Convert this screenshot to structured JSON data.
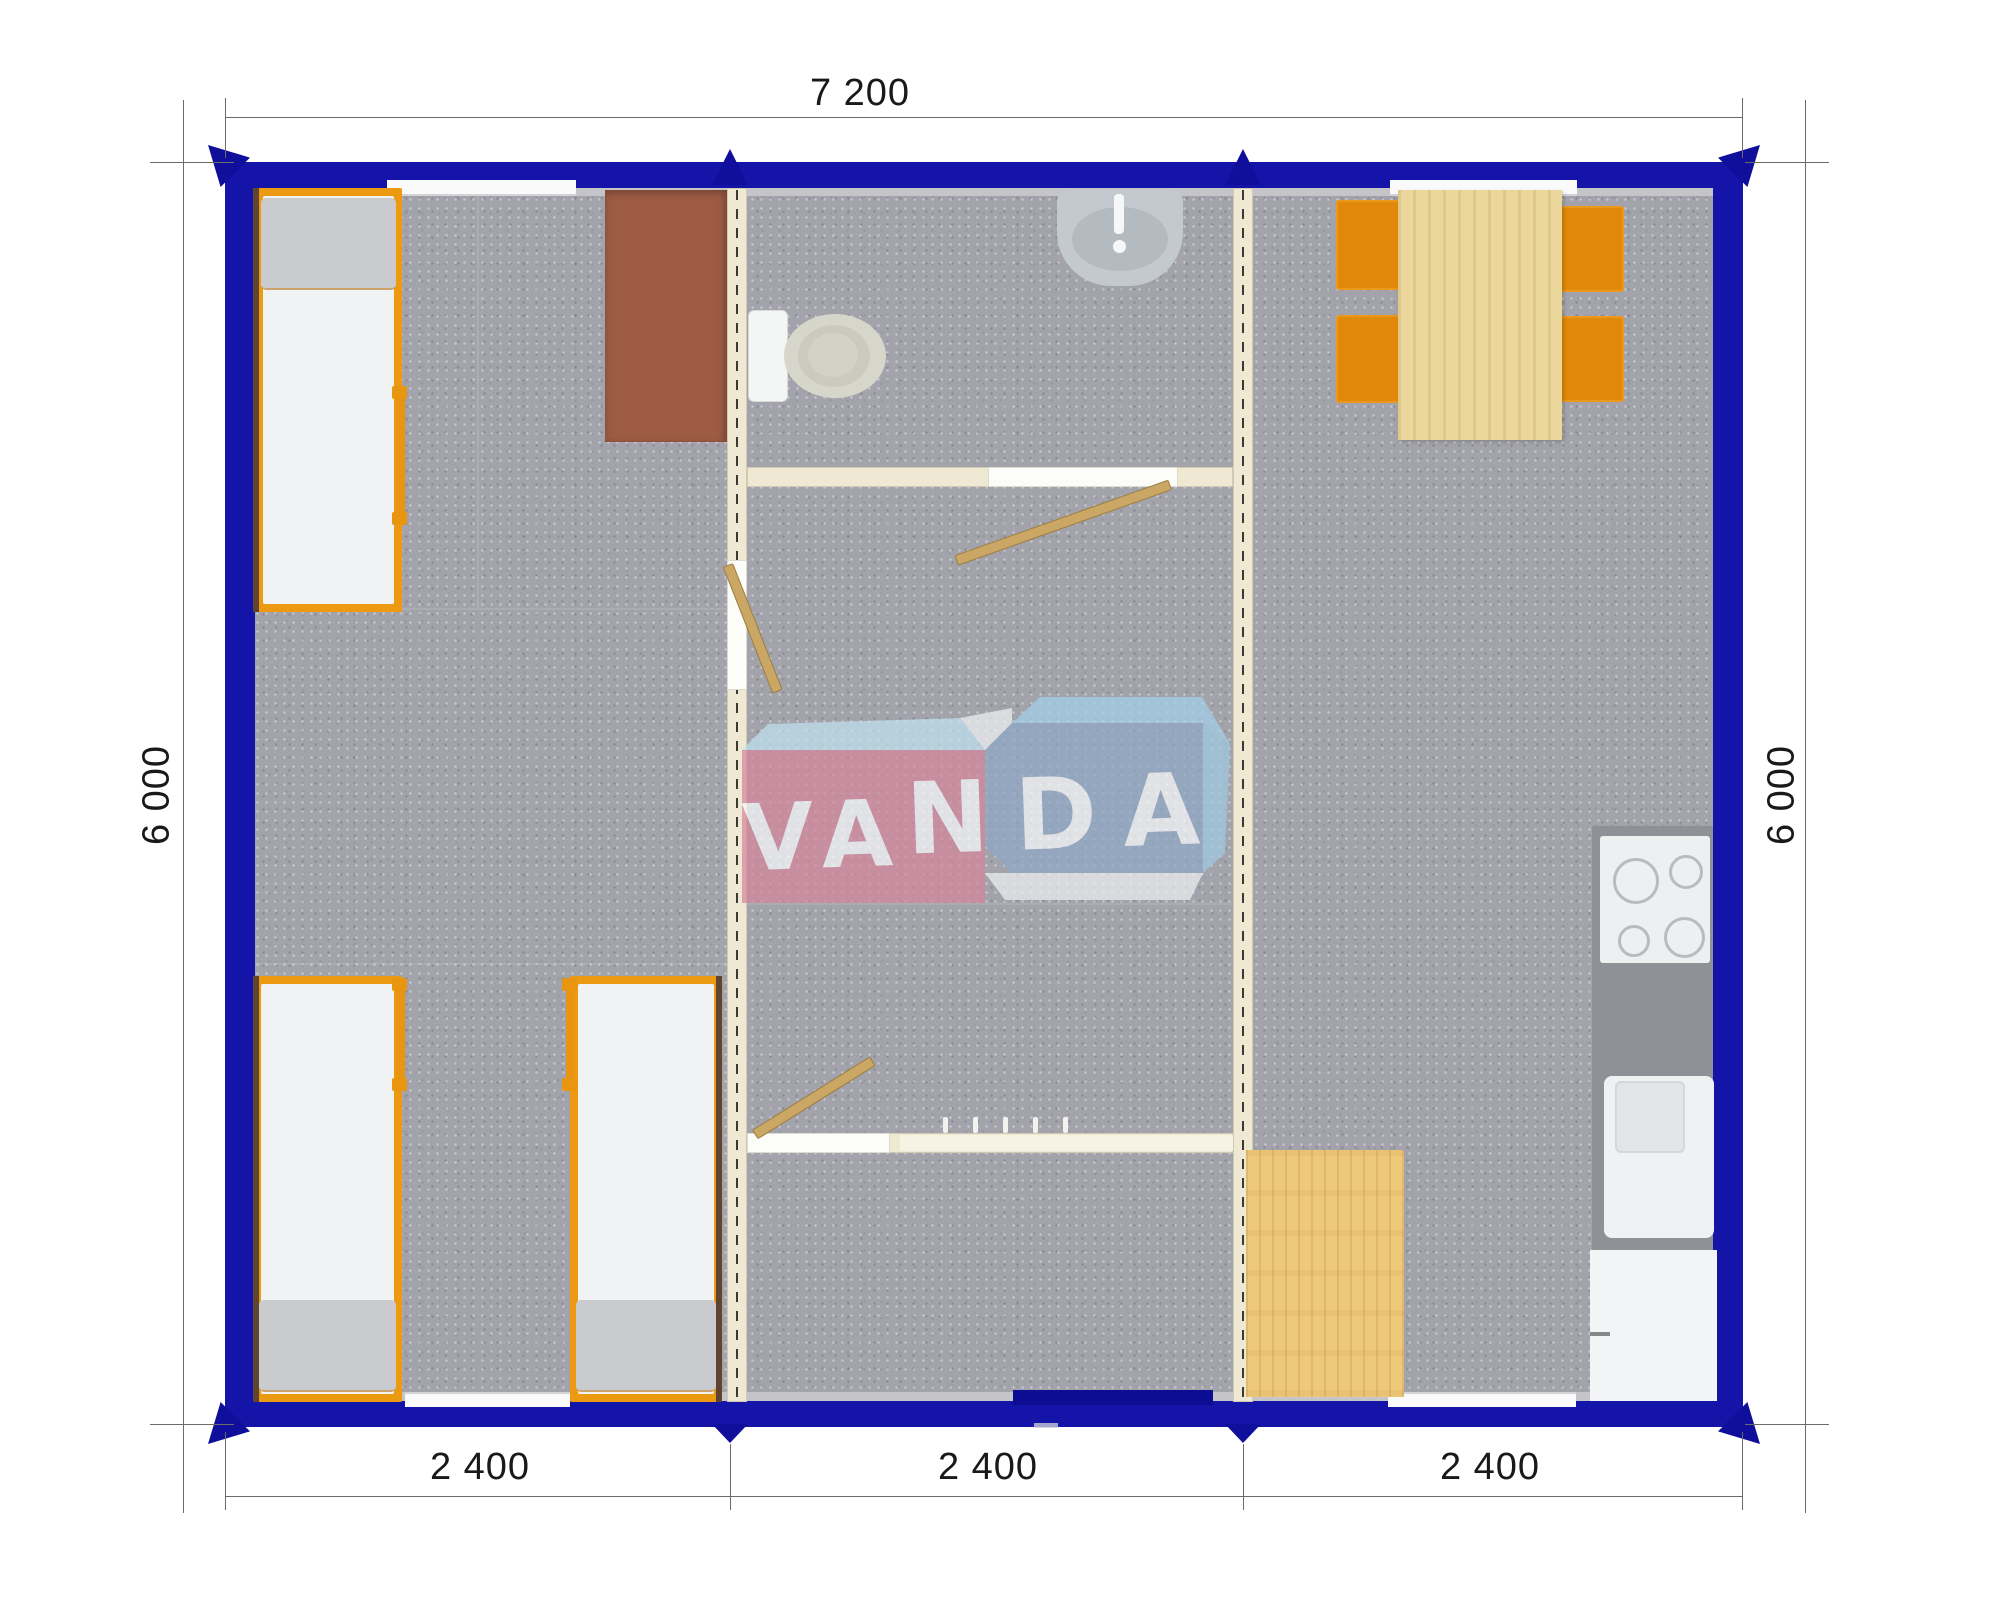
{
  "plan": {
    "type": "modular-building-floor-plan",
    "modules": [
      {
        "name": "bedroom-module",
        "furniture": [
          "bed",
          "bed",
          "bed",
          "wardrobe-desk"
        ]
      },
      {
        "name": "sanitary-entry-module",
        "furniture": [
          "toilet",
          "wash-basin",
          "door",
          "door",
          "door",
          "coat-hooks",
          "entrance-door"
        ]
      },
      {
        "name": "kitchen-dining-module",
        "furniture": [
          "dining-table",
          "chair",
          "chair",
          "chair",
          "chair",
          "cooktop",
          "kitchen-sink",
          "kitchen-cabinet",
          "side-table"
        ]
      }
    ]
  },
  "dimensions": {
    "top": "7 200",
    "left": "6 000",
    "right": "6 000",
    "bottom": [
      "2 400",
      "2 400",
      "2 400"
    ]
  },
  "watermark": {
    "full": "VANDA",
    "part1": "VA",
    "part2": "NDA"
  },
  "colors": {
    "wall_blue": "#1414A8",
    "arrow_blue": "#0F0F9C",
    "floor_gray": "#A3A3AB",
    "partition_cream": "#EFE8D3",
    "bed_frame_orange": "#EC9A12",
    "pillow_gray": "#C9CBCF",
    "desk_brown": "#9D5B44",
    "wood_light": "#EBD69C",
    "chair_orange": "#E2890B",
    "counter_gray": "#8F9196",
    "logo_pink": "#D5879B",
    "logo_blue": "#8FA9C7",
    "logo_sky": "#A4D2EA"
  }
}
